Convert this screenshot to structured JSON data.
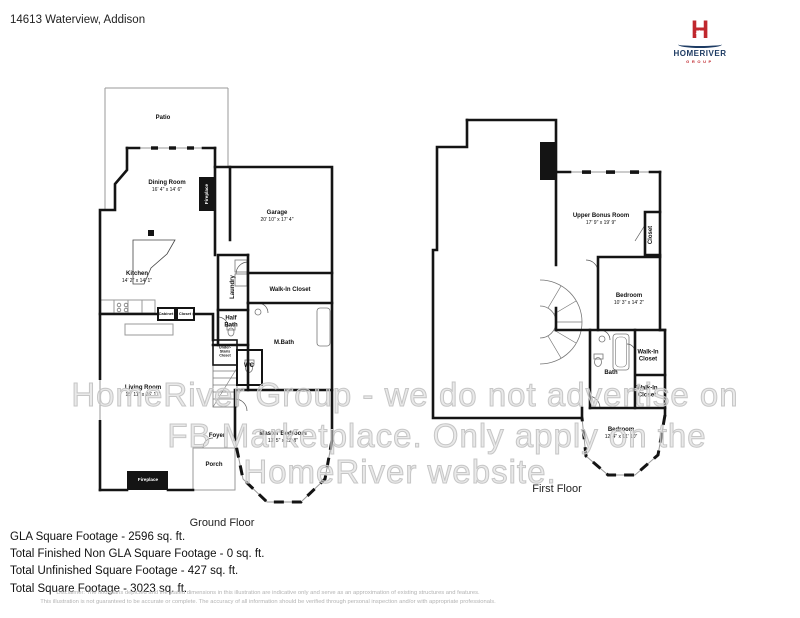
{
  "header": {
    "address": "14613 Waterview, Addison"
  },
  "logo": {
    "monogram": "H",
    "name": "HOMERIVER",
    "tagline": "GROUP"
  },
  "watermark": {
    "line1": "HomeRiver Group - we do not advertise on",
    "line2": "FB Marketplace. Only apply on the",
    "line3": "HomeRiver website."
  },
  "ground_floor": {
    "title": "Ground Floor",
    "rooms": {
      "patio": {
        "name": "Patio"
      },
      "dining": {
        "name": "Dining Room",
        "dims": "16' 4\" x 14' 6\""
      },
      "garage": {
        "name": "Garage",
        "dims": "20' 10\" x 17' 4\""
      },
      "kitchen": {
        "name": "Kitchen",
        "dims": "14' 2\" x 14' 1\""
      },
      "laundry": {
        "name": "Laundry"
      },
      "walk_in_closet": {
        "name": "Walk-In Closet"
      },
      "half_bath": {
        "name": "Half Bath"
      },
      "m_bath": {
        "name": "M.Bath"
      },
      "wc": {
        "name": "WC"
      },
      "under_stairs_closet": {
        "name": "Under-Stairs Closet"
      },
      "cabinet": {
        "name": "Cabinet"
      },
      "closet": {
        "name": "Closet"
      },
      "living": {
        "name": "Living Room",
        "dims": "15' 11\" x 26' 11\""
      },
      "foyer": {
        "name": "Foyer"
      },
      "porch": {
        "name": "Porch"
      },
      "master": {
        "name": "Master Bedroom",
        "dims": "13' 5\" x 22' 8\""
      },
      "fireplace_dining": {
        "name": "Fireplace"
      },
      "fireplace_living": {
        "name": "Fireplace"
      }
    }
  },
  "first_floor": {
    "title": "First Floor",
    "rooms": {
      "bonus": {
        "name": "Upper Bonus Room",
        "dims": "17' 9\" x 19' 9\""
      },
      "closet": {
        "name": "Closet"
      },
      "bedroom1": {
        "name": "Bedroom",
        "dims": "10' 3\" x 14' 2\""
      },
      "bath": {
        "name": "Bath"
      },
      "wic_upper": {
        "name": "Walk-In Closet"
      },
      "wic_lower": {
        "name": "Walk-In Closet"
      },
      "bedroom2": {
        "name": "Bedroom",
        "dims": "12' 4\" x 11' 10\""
      }
    }
  },
  "footer": {
    "lines": [
      "GLA Square Footage - 2596 sq. ft.",
      "Total Finished Non GLA Square Footage - 0 sq. ft.",
      "Total Unfinished Square Footage - 427 sq. ft.",
      "Total Square Footage - 3023 sq. ft."
    ]
  },
  "disclaimer": {
    "line1": "Disclaimer: The floorplans depicted and the stated dimensions in this illustration are indicative only and serve as an approximation of existing structures and features.",
    "line2": "This illustration is not guaranteed to be accurate or complete. The accuracy of all information should be verified through personal inspection and/or with appropriate professionals."
  }
}
